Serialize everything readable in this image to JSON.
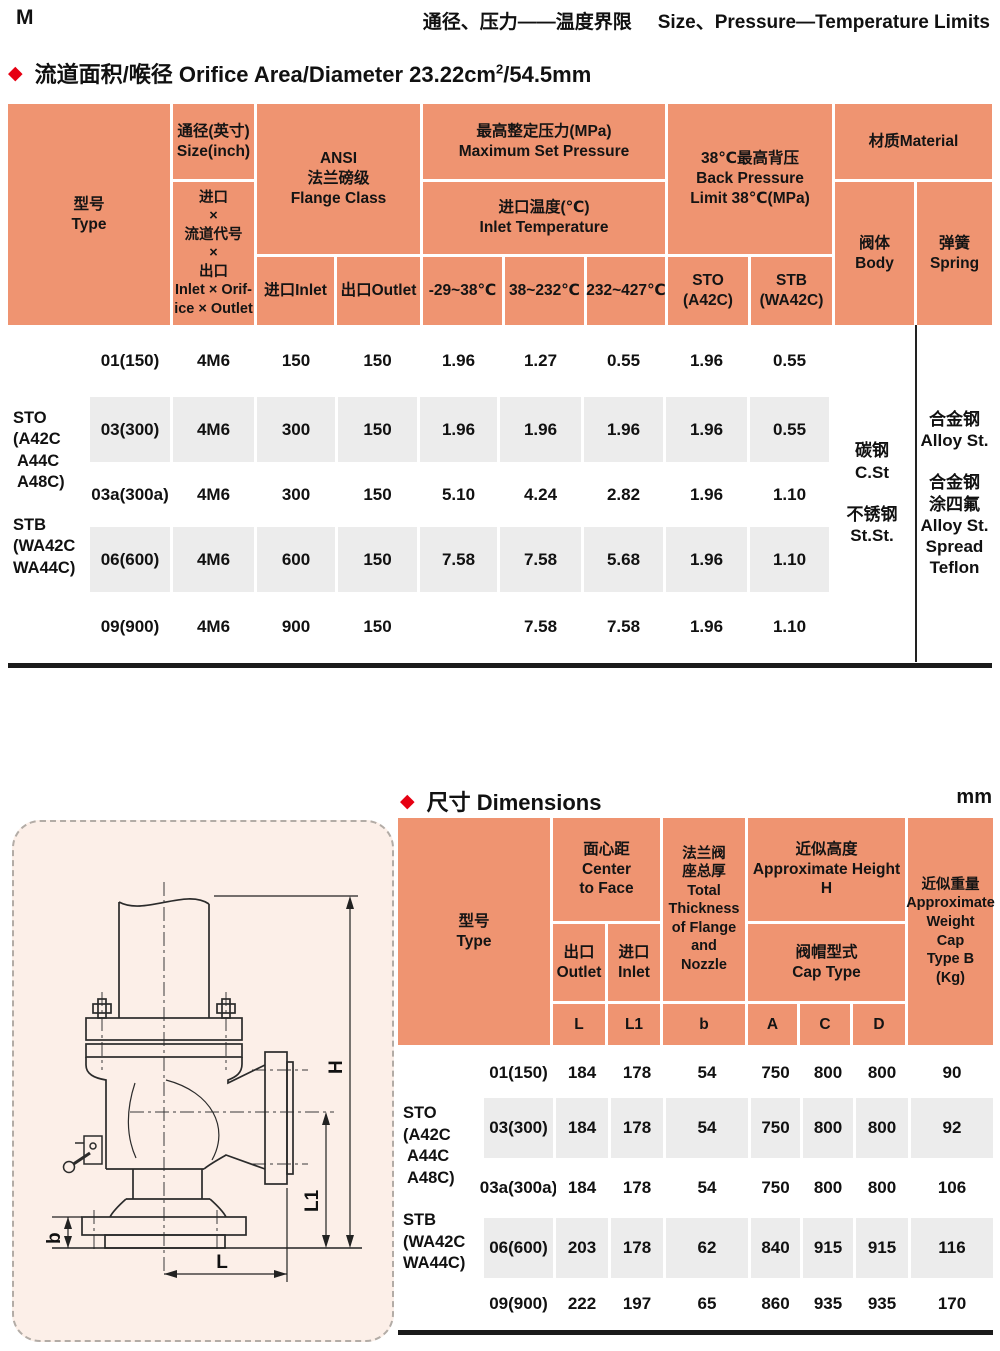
{
  "page": {
    "letter": "M",
    "title_zh": "通径、压力——温度界限",
    "title_en": "Size、Pressure—Temperature Limits"
  },
  "section1": {
    "title_prefix": "流道面积/喉径 Orifice Area/Diameter 23.22cm",
    "title_sup": "2",
    "title_suffix": "/54.5mm"
  },
  "table1": {
    "header": {
      "type": "型号\nType",
      "size_inch": "通径(英寸)\nSize(inch)",
      "inlet_orifice_outlet": "进口\n×\n流道代号\n×\n出口\nInlet × Orif-\nice × Outlet",
      "ansi": "ANSI\n法兰磅级\nFlange Class",
      "inlet": "进口Inlet",
      "outlet": "出口Outlet",
      "max_set_pressure": "最高整定压力(MPa)\nMaximum Set Pressure",
      "inlet_temperature": "进口温度(℃)\nInlet Temperature",
      "t1": "-29~38℃",
      "t2": "38~232℃",
      "t3": "232~427℃",
      "back_pressure": "38℃最高背压\nBack Pressure\nLimit 38℃(MPa)",
      "sto": "STO\n(A42C)",
      "stb": "STB\n(WA42C)",
      "material": "材质Material",
      "body": "阀体\nBody",
      "spring": "弹簧\nSpring"
    },
    "type_label": "STO\n(A42C\n A44C\n A48C)\n\nSTB\n(WA42C\nWA44C)",
    "body_material": "碳钢\nC.St\n\n不锈钢\nSt.St.",
    "spring_material": "合金钢\nAlloy St.\n\n合金钢\n涂四氟\nAlloy St.\nSpread\nTeflon",
    "rows": [
      {
        "size": "01(150)",
        "code": "4M6",
        "fin": "150",
        "fout": "150",
        "t1": "1.96",
        "t2": "1.27",
        "t3": "0.55",
        "sto": "1.96",
        "stb": "0.55"
      },
      {
        "size": "03(300)",
        "code": "4M6",
        "fin": "300",
        "fout": "150",
        "t1": "1.96",
        "t2": "1.96",
        "t3": "1.96",
        "sto": "1.96",
        "stb": "0.55"
      },
      {
        "size": "03a(300a)",
        "code": "4M6",
        "fin": "300",
        "fout": "150",
        "t1": "5.10",
        "t2": "4.24",
        "t3": "2.82",
        "sto": "1.96",
        "stb": "1.10"
      },
      {
        "size": "06(600)",
        "code": "4M6",
        "fin": "600",
        "fout": "150",
        "t1": "7.58",
        "t2": "7.58",
        "t3": "5.68",
        "sto": "1.96",
        "stb": "1.10"
      },
      {
        "size": "09(900)",
        "code": "4M6",
        "fin": "900",
        "fout": "150",
        "t1": "",
        "t2": "7.58",
        "t3": "7.58",
        "sto": "1.96",
        "stb": "1.10"
      }
    ]
  },
  "section2": {
    "title": "尺寸 Dimensions",
    "unit": "mm"
  },
  "table2": {
    "header": {
      "type": "型号\nType",
      "center_to_face": "面心距\nCenter\nto Face",
      "outlet": "出口\nOutlet",
      "inlet": "进口\nInlet",
      "L": "L",
      "L1": "L1",
      "total_thickness": "法兰阀\n座总厚\nTotal\nThickness\nof Flange\nand\nNozzle",
      "b": "b",
      "approx_height": "近似高度\nApproximate Height\nH",
      "cap_type": "阀帽型式\nCap Type",
      "A": "A",
      "C": "C",
      "D": "D",
      "approx_weight": "近似重量\nApproximate\nWeight\nCap\nType B\n(Kg)"
    },
    "rows": [
      {
        "size": "01(150)",
        "L": "184",
        "L1": "178",
        "b": "54",
        "A": "750",
        "C": "800",
        "D": "800",
        "W": "90"
      },
      {
        "size": "03(300)",
        "L": "184",
        "L1": "178",
        "b": "54",
        "A": "750",
        "C": "800",
        "D": "800",
        "W": "92"
      },
      {
        "size": "03a(300a)",
        "L": "184",
        "L1": "178",
        "b": "54",
        "A": "750",
        "C": "800",
        "D": "800",
        "W": "106"
      },
      {
        "size": "06(600)",
        "L": "203",
        "L1": "178",
        "b": "62",
        "A": "840",
        "C": "915",
        "D": "915",
        "W": "116"
      },
      {
        "size": "09(900)",
        "L": "222",
        "L1": "197",
        "b": "65",
        "A": "860",
        "C": "935",
        "D": "935",
        "W": "170"
      }
    ]
  },
  "drawing": {
    "labels": {
      "H": "H",
      "L1": "L1",
      "L": "L",
      "b": "b"
    }
  },
  "colors": {
    "header_salmon": "#ef9471",
    "row_gray": "#ececec",
    "drawing_pink": "#fcefe8",
    "accent_red": "#e60012"
  }
}
